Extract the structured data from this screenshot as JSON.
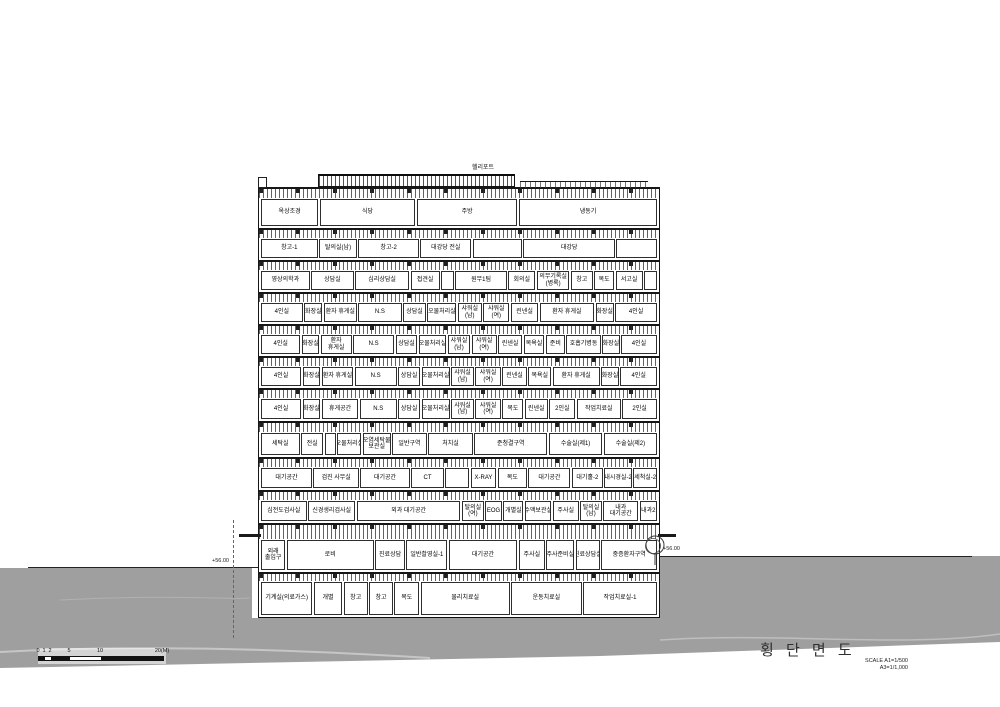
{
  "drawing": {
    "title": "횡 단 면 도",
    "scale_note_line1": "SCALE  A1=1/500",
    "scale_note_line2": "A3=1/1,000"
  },
  "annotations": {
    "helipad": "헬리포트",
    "ground_level_left": "+56.00",
    "ground_level_right": "+56.00"
  },
  "scale_bar": {
    "ticks": [
      "0",
      "1",
      "2",
      "5",
      "10",
      "20(M)"
    ]
  },
  "colors": {
    "ground_gray": "#9f9f9f",
    "line_black": "#1c1c1c",
    "title_text": "#2f2f2f"
  },
  "floors": [
    [
      "옥상조경",
      "식당",
      "주방",
      "냉동기"
    ],
    [
      "창고-1",
      "탈의실(남)",
      "창고-2",
      "대강당 전실",
      "",
      "대강당",
      ""
    ],
    [
      "영상의학과",
      "상담실",
      "심리상담실",
      "접견실",
      "",
      "원무1팀",
      "회의실",
      "의무기록실(병록)",
      "창고",
      "복도",
      "서고실",
      ""
    ],
    [
      "4인실",
      "화장실",
      "환자 휴게실",
      "N.S",
      "상담실",
      "오물처리실",
      "샤워실(남)",
      "샤워실(여)",
      "린넨실",
      "환자 휴게실",
      "화장실",
      "4인실"
    ],
    [
      "4인실",
      "화장실",
      "환자 휴게실",
      "N.S",
      "상담실",
      "오물처리실",
      "샤워실(남)",
      "샤워실(여)",
      "린넨실",
      "목욕실",
      "준비",
      "호흡기병동",
      "화장실",
      "4인실"
    ],
    [
      "4인실",
      "화장실",
      "환자 휴게실",
      "N.S",
      "상담실",
      "오물처리실",
      "샤워실(남)",
      "샤워실(여)",
      "린넨실",
      "목욕실",
      "환자 휴게실",
      "화장실",
      "4인실"
    ],
    [
      "4인실",
      "화장실",
      "휴게공간",
      "N.S",
      "상담실",
      "오물처리실",
      "샤워실(남)",
      "샤워실(여)",
      "복도",
      "린넨실",
      "2인실",
      "작업치료실",
      "2인실"
    ],
    [
      "세탁실",
      "전실",
      "",
      "오물처리실",
      "오염세탁물 보관실",
      "일반구역",
      "처치실",
      "준청결구역",
      "수술실(제1)",
      "수술실(제2)"
    ],
    [
      "대기공간",
      "검진 사무실",
      "대기공간",
      "CT",
      "",
      "X-RAY",
      "복도",
      "대기공간",
      "대기홀-2",
      "내시경실-2",
      "세척실-2"
    ],
    [
      "심전도검사실",
      "신경생리검사실",
      "외과 대기공간",
      "탈의실(여)",
      "EOG",
      "개별실",
      "수액보관실",
      "주사실",
      "탈의실(남)",
      "내과 대기공간",
      "내과2"
    ],
    [
      "외래 출입구",
      "로비",
      "진료상담",
      "일반촬영실-1",
      "대기공간",
      "주사실",
      "주사준비실",
      "진료상담실",
      "중증환자구역"
    ],
    [
      "기계실(의료가스)",
      "개별",
      "창고",
      "창고",
      "복도",
      "물리치료실",
      "운동치료실",
      "작업치료실-1"
    ]
  ]
}
